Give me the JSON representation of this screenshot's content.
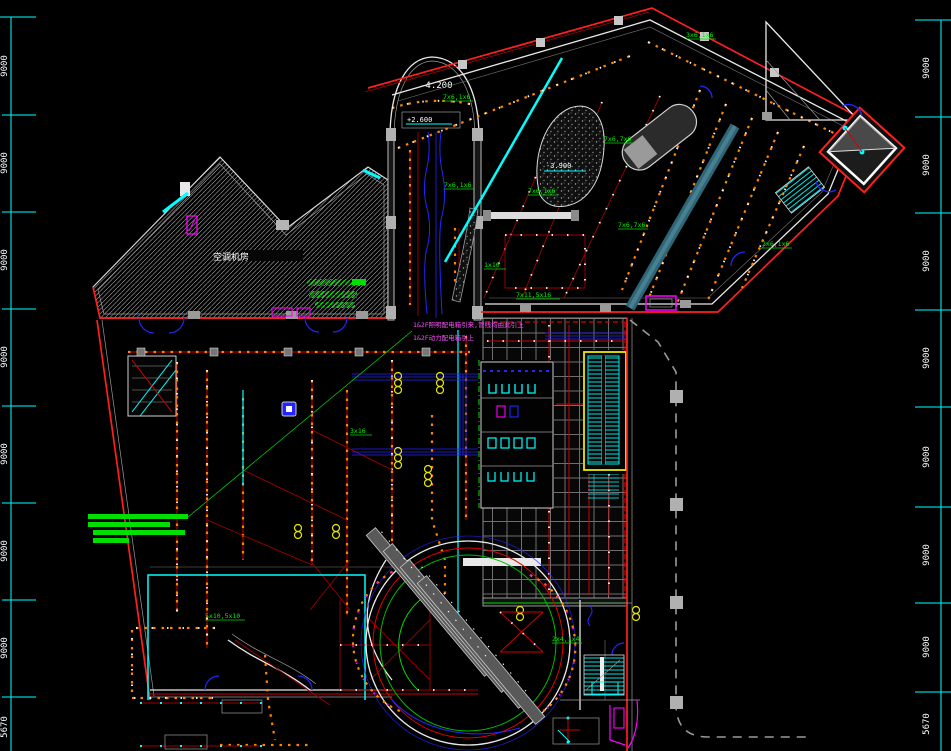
{
  "drawing": {
    "kind": "electrical-lighting-floor-plan",
    "background": "#000000",
    "dimensions": {
      "left": [
        "9000",
        "9000",
        "9000",
        "9000",
        "9000",
        "9000",
        "9000",
        "5670"
      ],
      "right": [
        "9000",
        "9000",
        "9000",
        "9000",
        "9000",
        "9000",
        "9000",
        "5670"
      ]
    },
    "annotations": {
      "level_tower": "-4.200",
      "level_box": "+2.600",
      "level_pit": "-3.900",
      "room_ac": "空调机房",
      "note1": "1&2F照明配电箱引来,管线均由此引上",
      "note2": "1&2F动力配电箱引上"
    },
    "circuit_tags": [
      "7x6,1x6",
      "7x6,7x6",
      "3x6,1x6",
      "7x6,1x6",
      "2x6,1x6",
      "7x6,7x6",
      "5x10,5x10",
      "7x6,1x6",
      "7x11,5x16",
      "3x16",
      "1x10",
      "2x4,1x4"
    ],
    "colors": {
      "dimension": "#00ffff",
      "boundary": "#ff1f1f",
      "circuit": "#cf0000",
      "lights": "#ff8400",
      "tags": "#00ee00",
      "notes": "#ff00ff",
      "walls": "#e8e8e8",
      "escalator_border": "#e9e900",
      "property_line": "#9a9a9a"
    }
  }
}
